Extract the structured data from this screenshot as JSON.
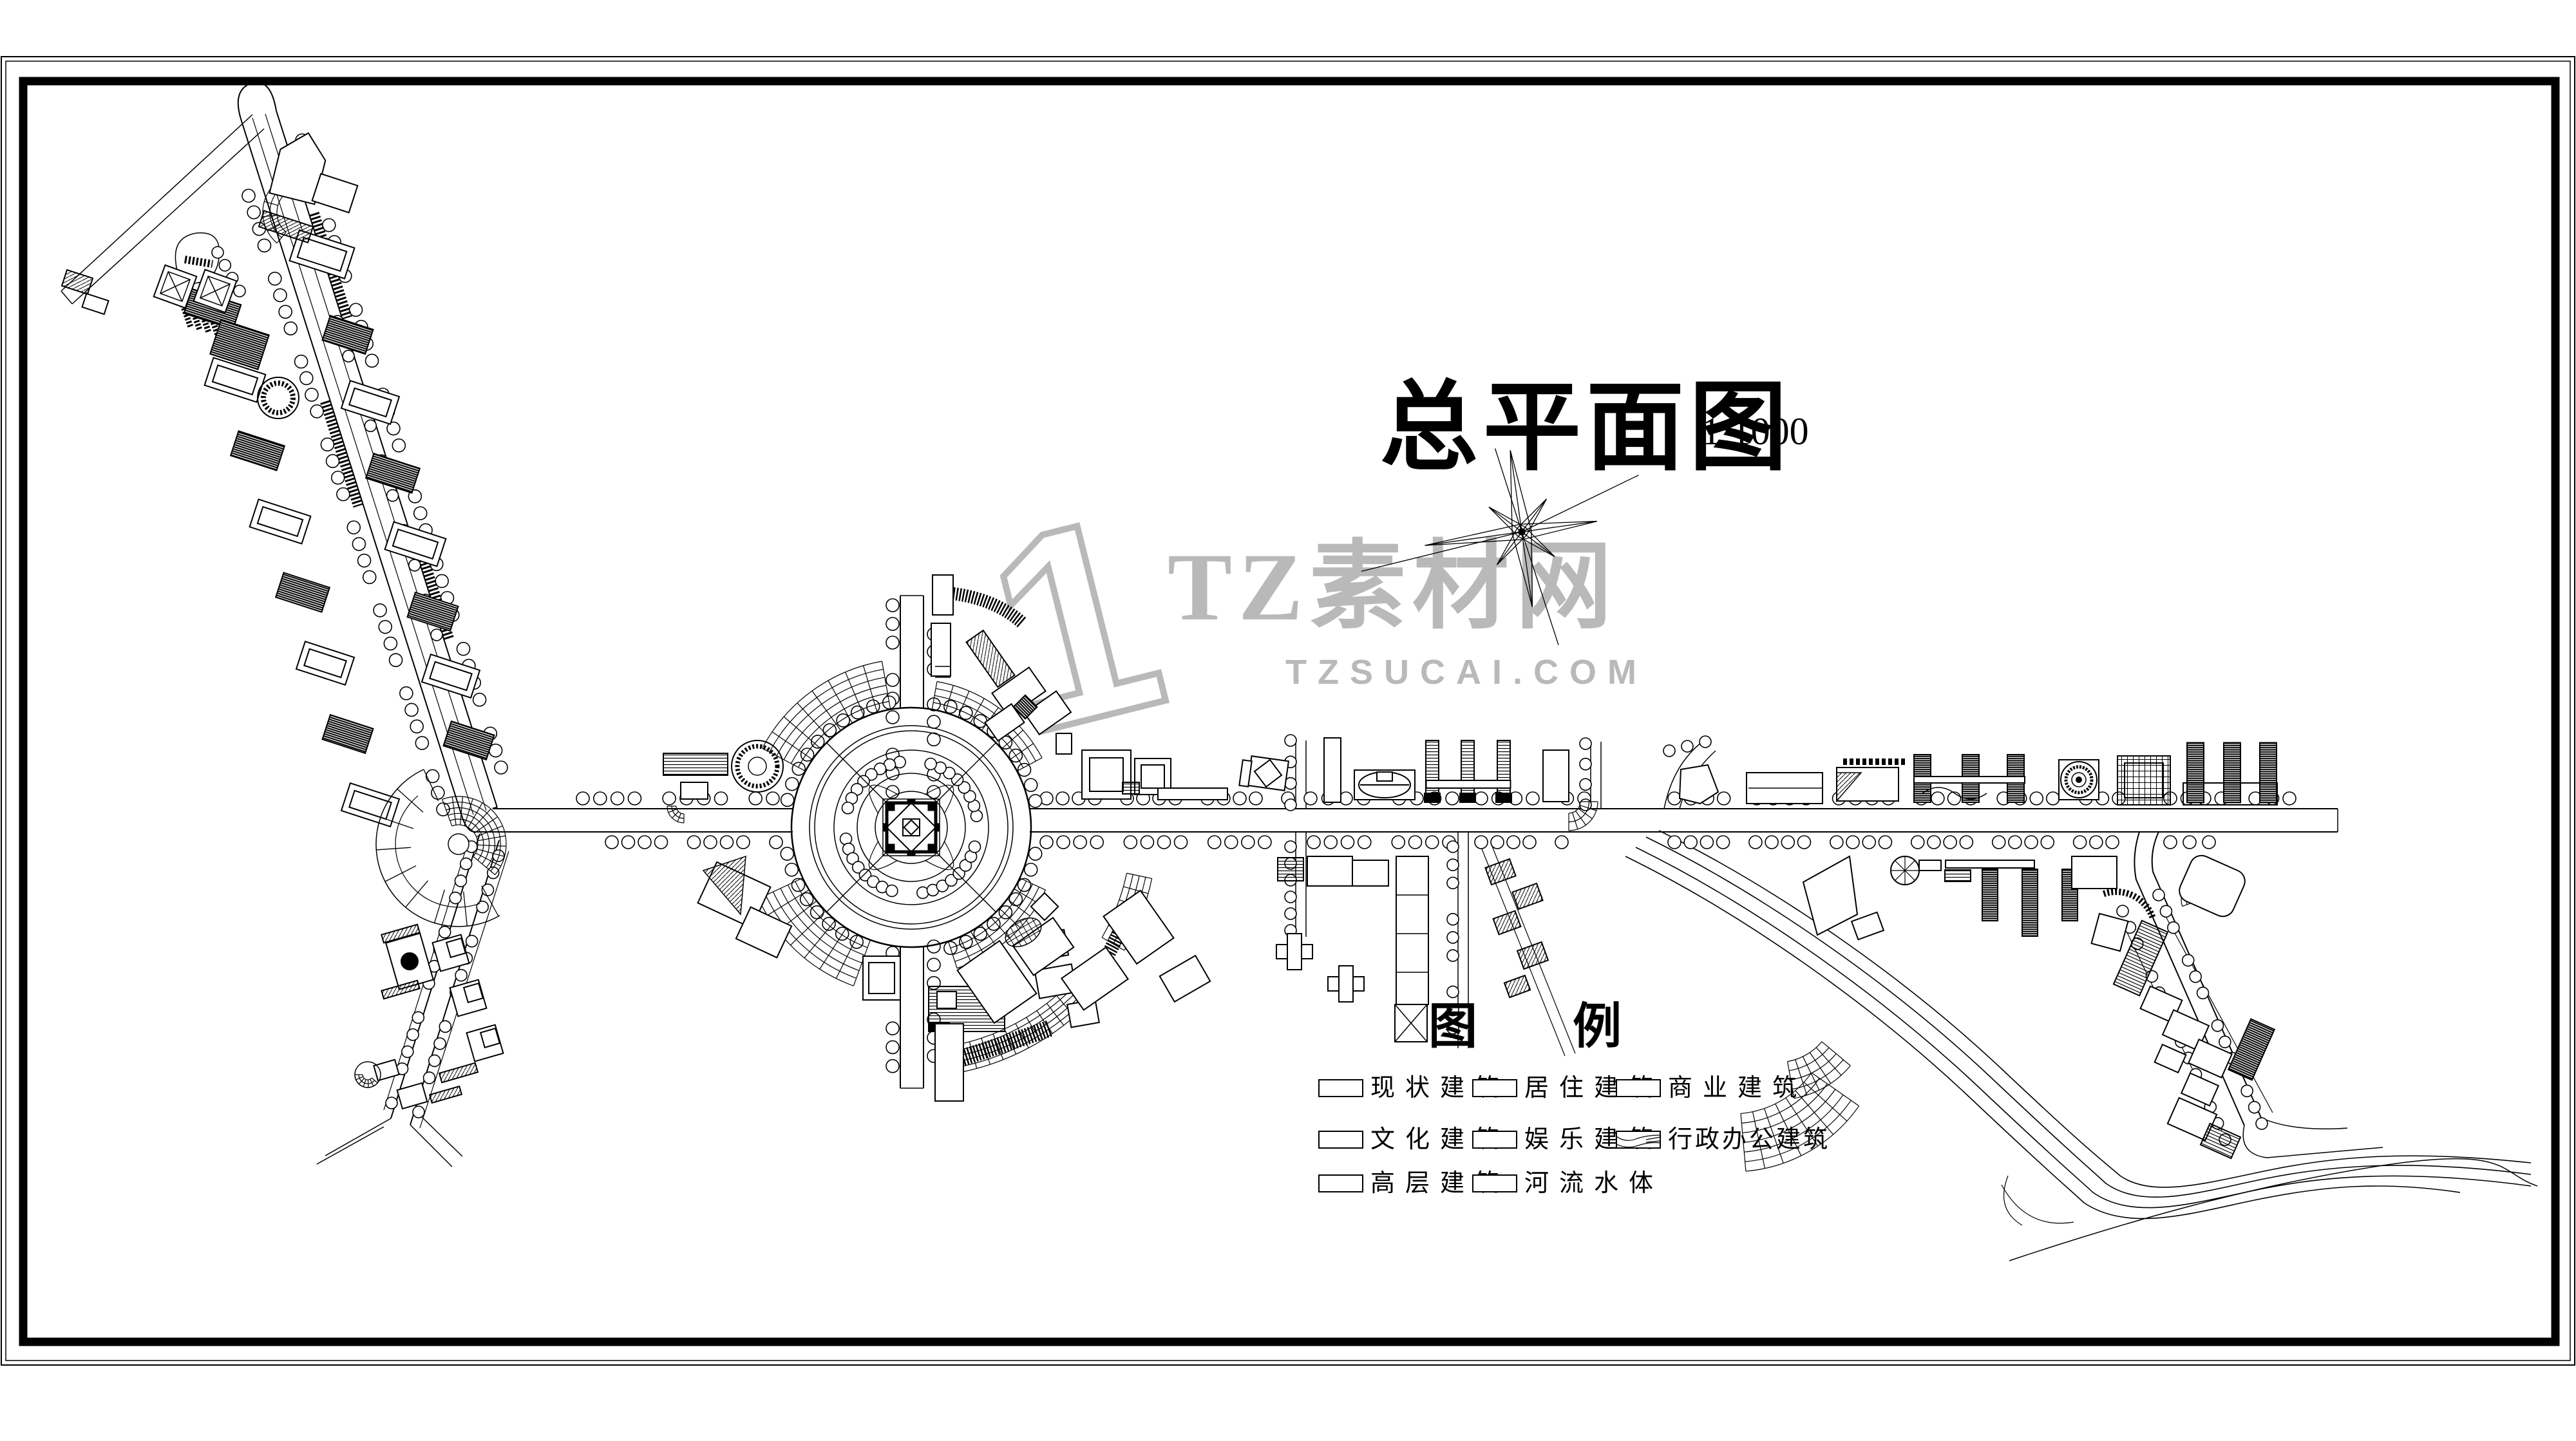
{
  "title": {
    "text": "总平面图",
    "scale": "1:1000"
  },
  "watermark": {
    "logo": "1",
    "brand": "TZ素材网",
    "domain": "TZSUCAI.COM",
    "color": "#b9b9b9"
  },
  "map": {
    "compass_icon": "compass-rose",
    "ink_color": "#000000",
    "features": [
      "central-circular-plaza",
      "northwest-boulevard",
      "southwest-arm",
      "east-west-main-road",
      "southeast-river",
      "southeast-branch-road"
    ]
  },
  "legend": {
    "title": "图例",
    "items": [
      {
        "label": "现状建筑",
        "swatch": "empty"
      },
      {
        "label": "居住建筑",
        "swatch": "empty"
      },
      {
        "label": "商业建筑",
        "swatch": "empty"
      },
      {
        "label": "文化建筑",
        "swatch": "empty"
      },
      {
        "label": "娱乐建筑",
        "swatch": "empty"
      },
      {
        "label": "行政办公建筑",
        "swatch": "wave-hatch"
      },
      {
        "label": "高层建筑",
        "swatch": "empty"
      },
      {
        "label": "河流水体",
        "swatch": "empty"
      }
    ]
  }
}
